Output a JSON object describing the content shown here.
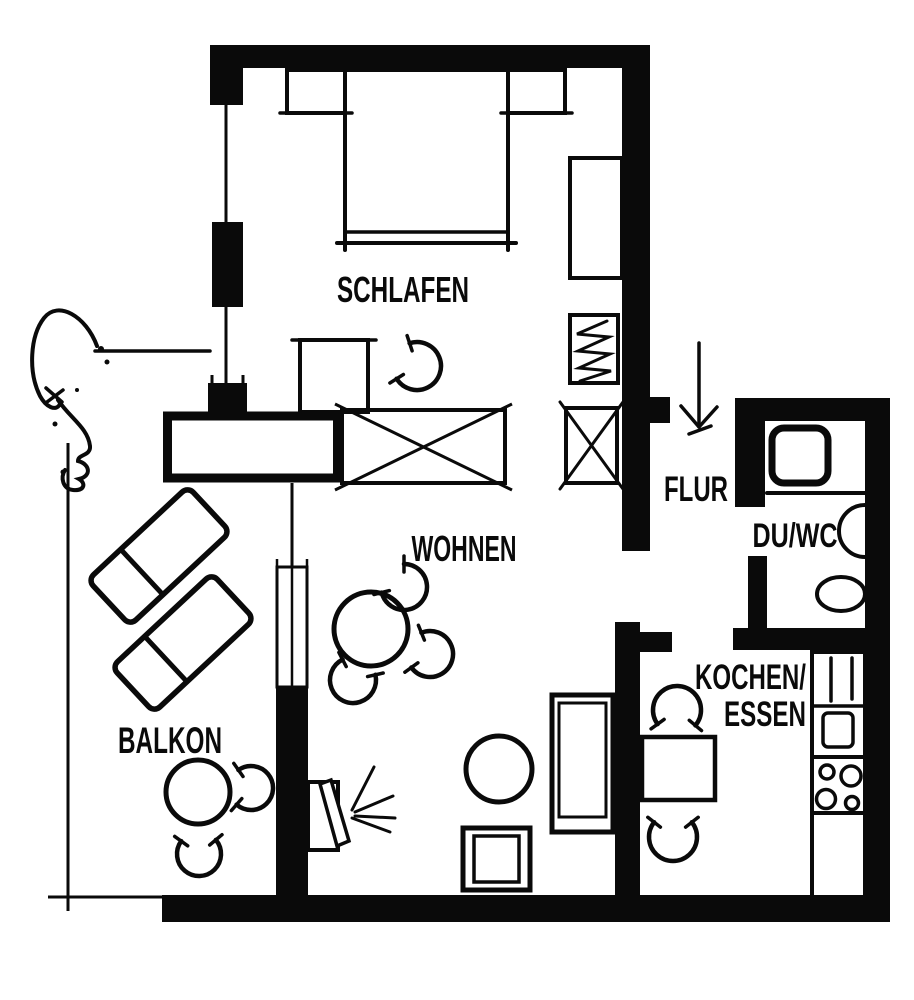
{
  "plan": {
    "type": "apartment-floor-plan",
    "style": "black-and-white scanned architectural drawing",
    "colors": {
      "ink": "#0a0a0a",
      "paper": "#ffffff"
    },
    "labels": {
      "schlafen": "SCHLAFEN",
      "wohnen": "WOHNEN",
      "balkon": "BALKON",
      "flur": "FLUR",
      "duwc": "DU/WC",
      "kochen_line1": "KOCHEN/",
      "kochen_line2": "ESSEN"
    },
    "symbols": [
      "double-bed",
      "nightstand",
      "wardrobe",
      "shelf-with-zigzag",
      "closet-x",
      "dressing-table",
      "chair-arc",
      "sideboard-partition",
      "dining-table",
      "sofa",
      "side-table",
      "square-table",
      "tv-with-rays",
      "lounger",
      "balcony-table",
      "kitchen-table",
      "kitchen-tall-unit",
      "sink",
      "cooktop",
      "counter",
      "shower-tray",
      "washbasin",
      "wc",
      "entrance-arrow",
      "hand-drawn-profile-doodle",
      "window-symbol"
    ]
  }
}
